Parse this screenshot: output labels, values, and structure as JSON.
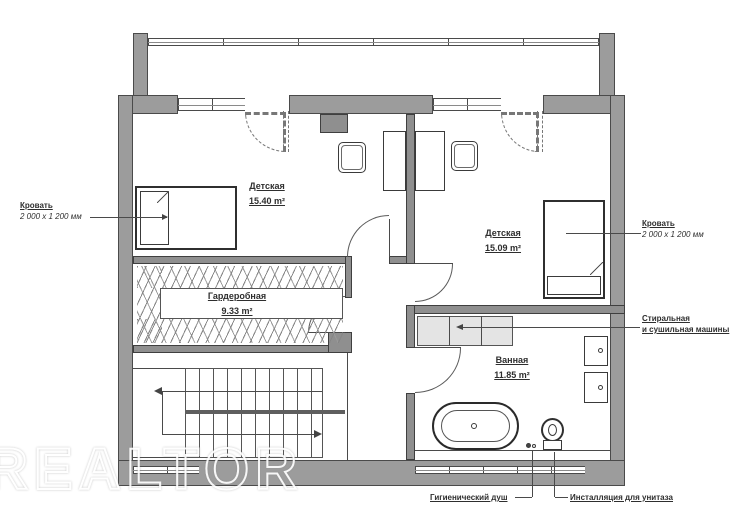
{
  "watermark": "REALTOR",
  "rooms": {
    "nursery_left": {
      "name": "Детская",
      "area": "15.40 m²"
    },
    "nursery_right": {
      "name": "Детская",
      "area": "15.09 m²"
    },
    "wardrobe": {
      "name": "Гардеробная",
      "area": "9.33 m²"
    },
    "bathroom": {
      "name": "Ванная",
      "area": "11.85 m²"
    }
  },
  "annotations": {
    "bed_left": {
      "title": "Кровать",
      "dims": "2 000 x 1 200 мм"
    },
    "bed_right": {
      "title": "Кровать",
      "dims": "2 000 x 1 200 мм"
    },
    "washer": {
      "line1": "Стиральная",
      "line2": "и сушильная машины"
    },
    "shower": {
      "label": "Гигиенический душ"
    },
    "toilet": {
      "label": "Инсталляция для унитаза"
    }
  },
  "colors": {
    "wall": "#9c9c9c",
    "partition": "#8f8f8f",
    "line": "#4a4a4a",
    "counter": "#e4e4e4",
    "text": "#2e2e2e"
  }
}
